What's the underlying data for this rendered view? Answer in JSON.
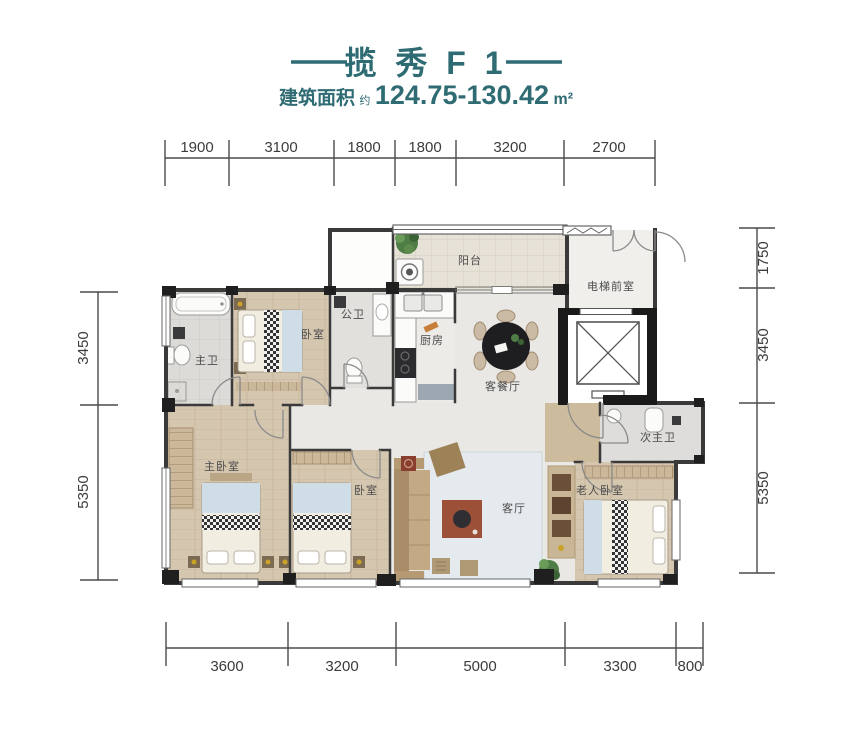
{
  "header": {
    "title": "揽 秀 F 1",
    "area_label": "建筑面积",
    "area_approx": "约",
    "area_value": "124.75-130.42",
    "area_unit": "m²"
  },
  "colors": {
    "accent": "#2E6B73",
    "wall": "#3A3A3A",
    "dimension_line": "#4A4A4A",
    "wood_floor": "#D5C6AF",
    "tile_floor": "#DCDBD7",
    "marble_floor": "#E9E8E4",
    "balcony_floor": "#E7E2D8"
  },
  "dimensions": {
    "top": [
      "1900",
      "3100",
      "1800",
      "1800",
      "3200",
      "2700"
    ],
    "bottom": [
      "3600",
      "3200",
      "5000",
      "3300",
      "800"
    ],
    "left": [
      "3450",
      "5350"
    ],
    "right": [
      "1750",
      "3450",
      "5350"
    ]
  },
  "rooms": {
    "balcony": "阳台",
    "elevator_lobby": "电梯前室",
    "master_bath": "主卫",
    "bedroom_top": "卧室",
    "public_bath": "公卫",
    "kitchen": "厨房",
    "dining_room": "客餐厅",
    "second_master_bath": "次主卫",
    "master_bedroom": "主卧室",
    "bedroom_second": "卧室",
    "living_room": "客厅",
    "elder_bedroom": "老人卧室"
  }
}
